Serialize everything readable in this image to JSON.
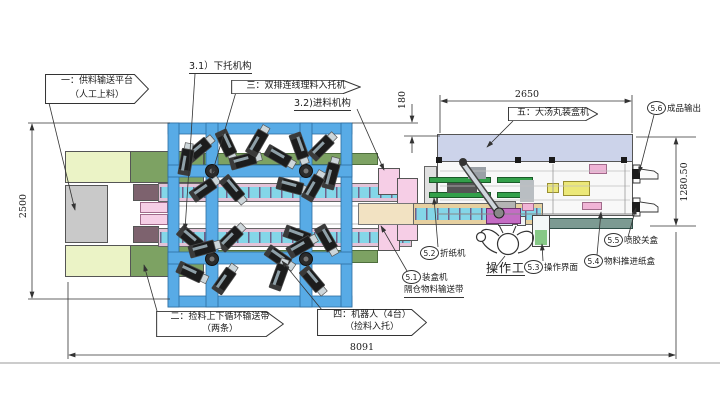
{
  "drawing": {
    "type": "factory-line-layout-cad-drawing",
    "callouts": {
      "c1": {
        "line1": "一：供料输送平台",
        "line2": "（人工上料）"
      },
      "c2": {
        "line1": "二：捡料上下循环输送带",
        "line2": "（两条）"
      },
      "c3": {
        "text": "三：双排连线理料入托机"
      },
      "c4": {
        "line1": "四：机器人（4台）",
        "line2": "（捡料入托）"
      },
      "c5": {
        "text": "五：大汤丸装盒机"
      }
    },
    "sub_labels": {
      "s31": "3.1）下托机构",
      "s32": "3.2)进料机构",
      "operator": "操作工",
      "compartment_belt": "隔仓物料输送带"
    },
    "numbered_items": [
      {
        "num": "5.1",
        "text": "装盒机"
      },
      {
        "num": "5.2",
        "text": "折纸机"
      },
      {
        "num": "5.3",
        "text": "操作界面"
      },
      {
        "num": "5.4",
        "text": "物料推进纸盒"
      },
      {
        "num": "5.5",
        "text": "喷胶关盒"
      },
      {
        "num": "5.6",
        "text": "成品输出"
      }
    ],
    "dimensions": {
      "left_height": "2500",
      "total_length": "8091",
      "cartoner_length": "2650",
      "feed_gap": "180",
      "right_height": "1280.50"
    },
    "colors": {
      "frame_blue": "#58abe6",
      "conveyor_cyan": "#84d6e8",
      "strip_green": "#7da263",
      "pale_yellow": "#ebf3c6",
      "gray_block": "#c9c9c9",
      "mauve": "#7d626e",
      "pink": "#f6cee6",
      "lavender_band": "#ccd3ea",
      "teal_band": "#7c9a92",
      "tan_belt": "#e6d0a0",
      "cream_platform": "#f2e2c2",
      "machine_yellow": "#ece878",
      "purple_base": "#c46cc4",
      "rail_green": "#33a04a"
    },
    "machine": {
      "robot_cell": {
        "nodes": [
          [
            212,
            171
          ],
          [
            306,
            171
          ],
          [
            212,
            259
          ],
          [
            306,
            259
          ]
        ],
        "robots": [
          [
            198,
            150,
            -40
          ],
          [
            226,
            143,
            65
          ],
          [
            243,
            161,
            -15
          ],
          [
            278,
            156,
            30
          ],
          [
            299,
            146,
            70
          ],
          [
            321,
            148,
            -45
          ],
          [
            331,
            176,
            -75
          ],
          [
            186,
            162,
            -80
          ],
          [
            257,
            143,
            -60
          ],
          [
            203,
            190,
            -35
          ],
          [
            232,
            188,
            50
          ],
          [
            290,
            186,
            15
          ],
          [
            313,
            188,
            -60
          ],
          [
            190,
            238,
            40
          ],
          [
            230,
            239,
            -45
          ],
          [
            297,
            235,
            20
          ],
          [
            326,
            238,
            60
          ],
          [
            202,
            249,
            -15
          ],
          [
            190,
            272,
            25
          ],
          [
            224,
            281,
            -55
          ],
          [
            278,
            257,
            35
          ],
          [
            300,
            247,
            -30
          ],
          [
            279,
            277,
            -70
          ],
          [
            312,
            279,
            50
          ]
        ]
      }
    }
  }
}
